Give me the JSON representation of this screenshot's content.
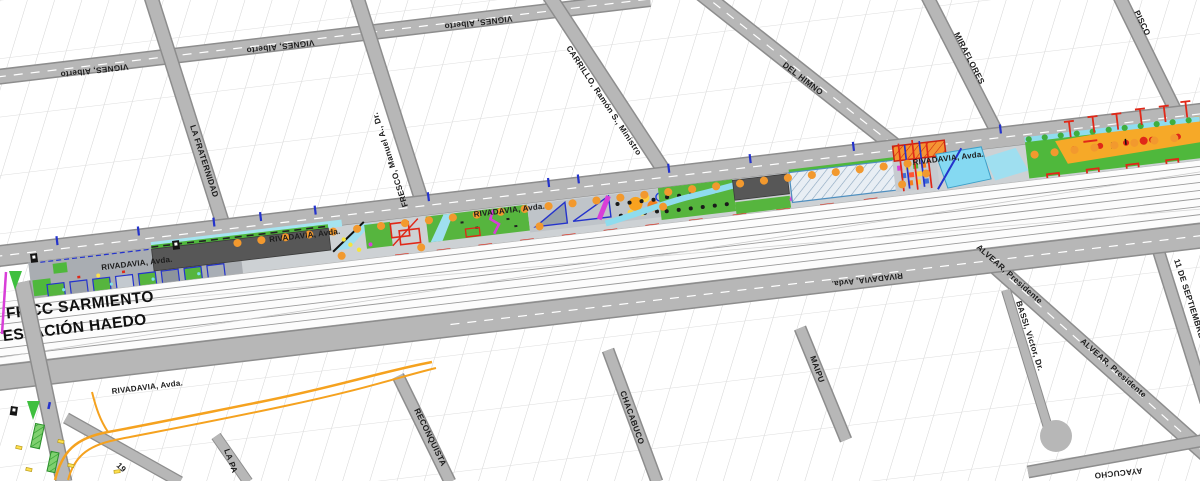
{
  "map_title": {
    "railway": "FF CC SARMIENTO",
    "station": "ESTACIÓN HAEDO"
  },
  "streets": {
    "vignes": "VIGNES, Alberto",
    "la_fraternidad": "LA FRATERNIDAD",
    "fresco": "FRESCO, Manuel A., Dr.",
    "carrillo": "CARRILLO, Ramón S., Ministro",
    "del_himno": "DEL HIMNO",
    "miraflores": "MIRAFLORES",
    "pisco": "PISCO",
    "rivadavia": "RIVADAVIA, Avda.",
    "reconquista": "RECONQUISTA",
    "chacabuco": "CHACABUCO",
    "maipu": "MAIPU",
    "ayacucho": "AYACUCHO",
    "alvear": "ALVEAR, Presidente",
    "bassi": "BASSI, Victor, Dr.",
    "once_de_septiembre": "11 DE SEPTIEMBRE",
    "la_pa_truncated": "LA PA",
    "street_19_truncated": "19"
  },
  "legend": {
    "park_green": "#4fb83c",
    "path_cyan": "#8fdcee",
    "water_cyan": "#85d9f2",
    "parking_dark": "#575757",
    "tree_orange": "#f2992e",
    "structure_red": "#e02818",
    "path_magenta": "#d83fd8",
    "plaza_orange": "#f6a928",
    "building_blue": "#2433cc",
    "bus_route_orange": "#f5a21f",
    "street_gray": "#b6b6b6"
  }
}
